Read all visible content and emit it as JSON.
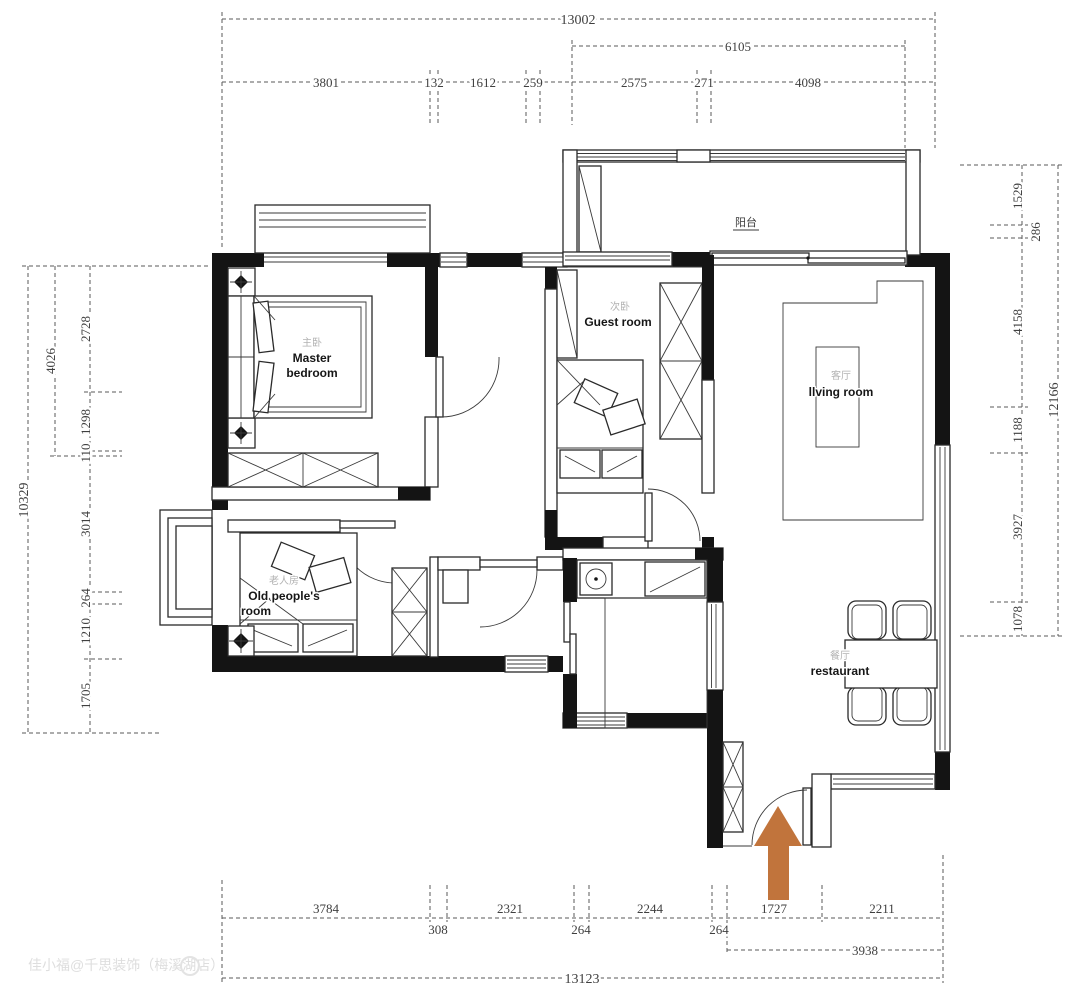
{
  "meta": {
    "watermark": "佳小福@千思装饰（梅溪湖店）"
  },
  "colors": {
    "wall": "#141414",
    "dimension_line": "#5a5a5a",
    "dimension_text": "#3f3f3f",
    "entrance_arrow": "#c1743c",
    "room_label_en": "#161616",
    "room_label_zh": "#b2b2b2",
    "watermark": "#dedede"
  },
  "rooms": {
    "master_bedroom": {
      "zh": "主卧",
      "en_line1": "Master",
      "en_line2": "bedroom"
    },
    "guest_room": {
      "zh": "次卧",
      "en": "Guest room"
    },
    "living_room": {
      "zh": "客厅",
      "en": "llving room"
    },
    "old_people_room": {
      "zh": "老人房",
      "en_line1": "Old people's",
      "en_line2": "room"
    },
    "restaurant": {
      "zh": "餐厅",
      "en": "restaurant"
    },
    "balcony": {
      "zh": "阳台"
    }
  },
  "dimensions": {
    "top": {
      "overall": "13002",
      "sub": "6105",
      "segments": [
        "3801",
        "132",
        "1612",
        "259",
        "2575",
        "271",
        "4098"
      ]
    },
    "bottom": {
      "overall": "13123",
      "sub": "3938",
      "segments": [
        "3784",
        "308",
        "2321",
        "264",
        "2244",
        "264",
        "1727",
        "2211"
      ]
    },
    "left": {
      "overall": "10329",
      "sub": "4026",
      "segments": [
        "2728",
        "1298",
        "110",
        "3014",
        "264",
        "1210",
        "1705"
      ]
    },
    "right": {
      "overall": "12166",
      "segments": [
        "1529",
        "286",
        "4158",
        "1188",
        "3927",
        "1078"
      ]
    }
  }
}
